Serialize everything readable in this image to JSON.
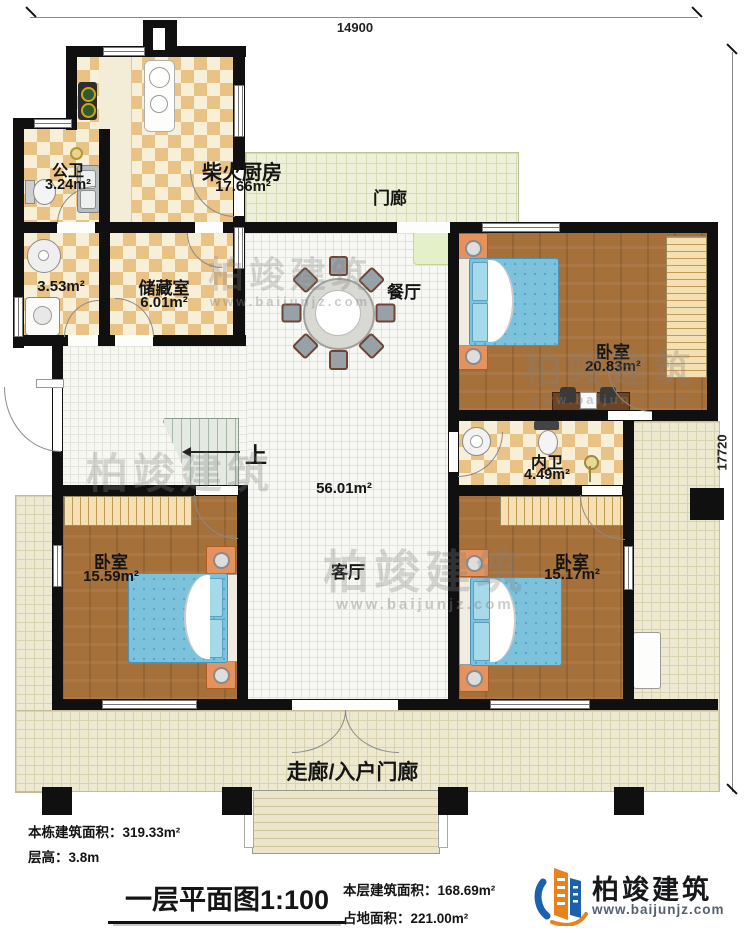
{
  "dimensions": {
    "top": "14900",
    "right": "17720"
  },
  "rooms": {
    "kitchen": {
      "name": "柴火厨房",
      "area": "17.66m²"
    },
    "public_bath": {
      "name": "公卫",
      "area": "3.24m²"
    },
    "laundry": {
      "area": "3.53m²"
    },
    "storage": {
      "name": "储藏室",
      "area": "6.01m²"
    },
    "porch": {
      "name": "门廊"
    },
    "dining": {
      "name": "餐厅"
    },
    "living": {
      "name": "客厅",
      "area": "56.01m²"
    },
    "bedroom_top_right": {
      "name": "卧室",
      "area": "20.83m²"
    },
    "inner_bath": {
      "name": "内卫",
      "area": "4.49m²"
    },
    "bedroom_bottom_left": {
      "name": "卧室",
      "area": "15.59m²"
    },
    "bedroom_bottom_right": {
      "name": "卧室",
      "area": "15.17m²"
    },
    "corridor": {
      "name": "走廊/入户门廊"
    },
    "stairs": {
      "label": "上"
    }
  },
  "info": {
    "left_line1": "本栋建筑面积：319.33m²",
    "left_line2": "层高：3.8m",
    "title": "一层平面图1:100",
    "right_line1": "本层建筑面积：168.69m²",
    "right_line2": "占地面积：221.00m²"
  },
  "branding": {
    "name": "柏竣建筑",
    "url": "www.baijunjz.com",
    "brand_blue": "#1a62ad",
    "brand_orange": "#e8821e"
  },
  "watermark": {
    "text": "柏竣建筑",
    "url": "www.baijunjz.com"
  }
}
